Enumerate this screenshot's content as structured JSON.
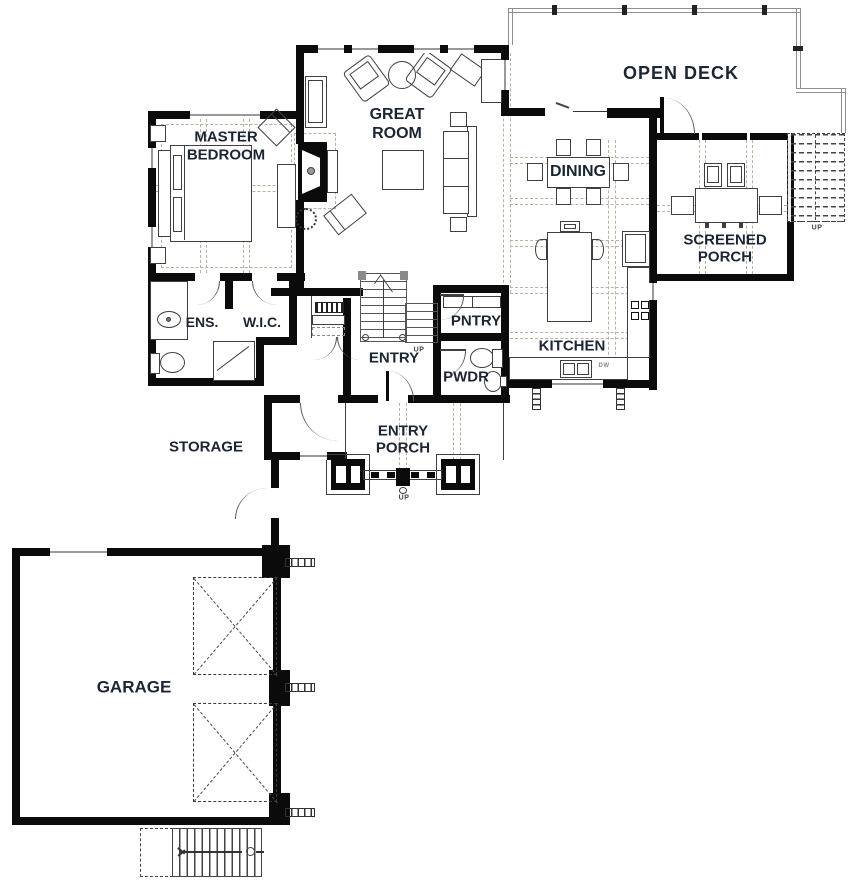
{
  "colors": {
    "wall": "#0b0b0b",
    "label": "#1c2533",
    "ceiling_dash": "#b9b19e",
    "deck_edge": "#8f8f8f"
  },
  "rooms": {
    "open_deck": "OPEN DECK",
    "great_1": "GREAT",
    "great_2": "ROOM",
    "master_1": "MASTER",
    "master_2": "BEDROOM",
    "dining": "DINING",
    "screened_1": "SCREENED",
    "screened_2": "PORCH",
    "ens": "ENS.",
    "wic": "W.I.C.",
    "pntry": "PNTRY",
    "entry": "ENTRY",
    "pwdr": "PWDR",
    "kitchen": "KITCHEN",
    "entry_porch_1": "ENTRY",
    "entry_porch_2": "PORCH",
    "storage": "STORAGE",
    "garage": "GARAGE"
  },
  "annotations": {
    "up": "UP",
    "dw": "DW"
  }
}
